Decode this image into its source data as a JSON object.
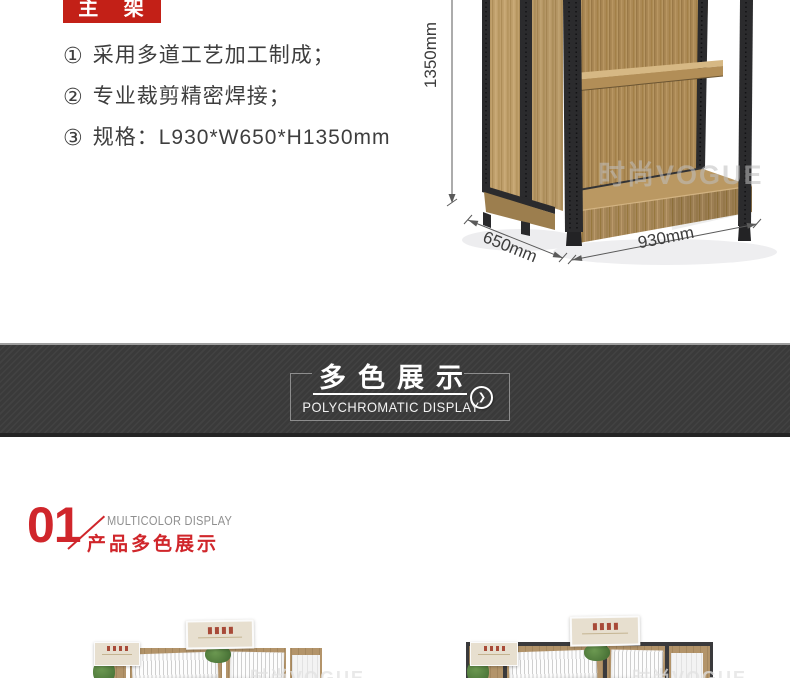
{
  "page": {
    "width": 790,
    "height": 678,
    "background": "#ffffff"
  },
  "colors": {
    "accent_red": "#c32017",
    "section_red": "#d0262b",
    "banner_bg": "#3b3b3b",
    "banner_border_top": "#9e9e9e",
    "wood_main": "#ab8955",
    "frame_black": "#2b2b2d",
    "photo_left_frame": "#ffffff",
    "photo_right_frame": "#3a3a3c",
    "text_dark": "#3e3e3e",
    "text_gray": "#8f8f8f"
  },
  "main_frame_section": {
    "badge_label": "主 架",
    "features": [
      {
        "marker": "①",
        "text": "采用多道工艺加工制成；"
      },
      {
        "marker": "②",
        "text": "专业裁剪精密焊接；"
      },
      {
        "marker": "③",
        "text": "规格：L930*W650*H1350mm"
      }
    ],
    "shelf": {
      "dim_height": "1350mm",
      "dim_depth": "650mm",
      "dim_width": "930mm",
      "watermark": "时尚VOGUE"
    }
  },
  "banner": {
    "title": "多色展示",
    "subtitle": "POLYCHROMATIC DISPLAY",
    "arrow_glyph": "❯"
  },
  "display_section": {
    "number": "01",
    "label_en": "MULTICOLOR DISPLAY",
    "label_cn": "产品多色展示"
  },
  "photos": {
    "watermark": "时尚VOGUE"
  }
}
